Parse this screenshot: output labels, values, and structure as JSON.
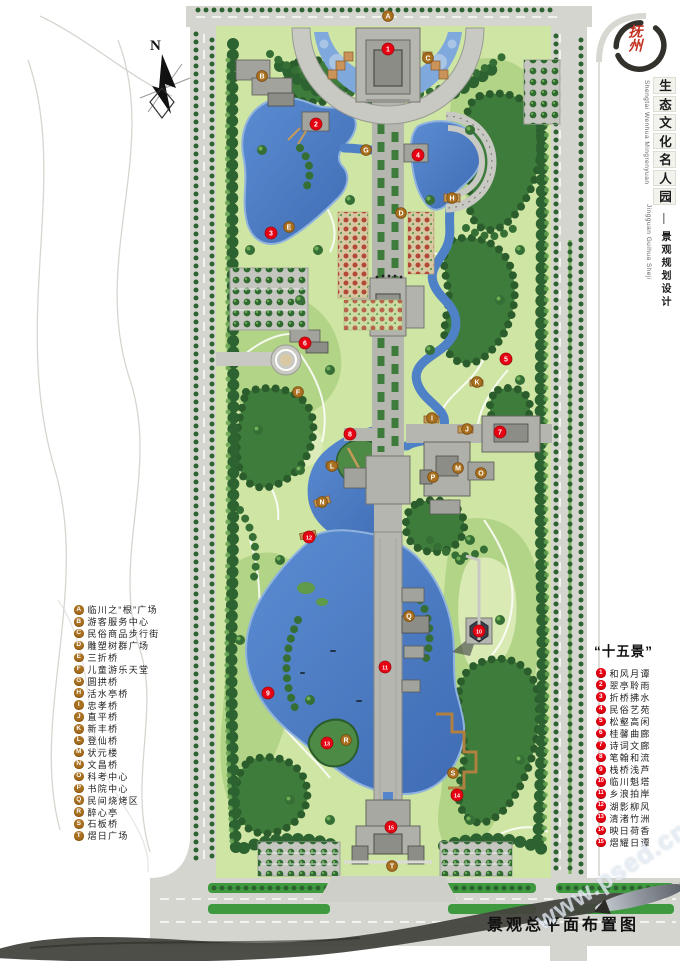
{
  "page": {
    "north_label": "N",
    "watermark": "www.psed.cn",
    "bottom_title": "景观总平面布置图"
  },
  "title_block": {
    "seal_text": "抚州",
    "main_title": "生态文化名人园",
    "main_title_pinyin": "Shengtai Wenhua Mingrenyuan",
    "separator": "—",
    "subtitle": "景观规划设计",
    "subtitle_pinyin": "Jingguan Guihua Sheji"
  },
  "legend_facilities": {
    "items": [
      {
        "key": "A",
        "label": "临川之“根”广场",
        "x": 388,
        "y": 16
      },
      {
        "key": "B",
        "label": "游客服务中心",
        "x": 262,
        "y": 76
      },
      {
        "key": "C",
        "label": "民俗商品步行街",
        "x": 428,
        "y": 58
      },
      {
        "key": "D",
        "label": "雕塑树群广场",
        "x": 401,
        "y": 213
      },
      {
        "key": "E",
        "label": "三折桥",
        "x": 289,
        "y": 227
      },
      {
        "key": "F",
        "label": "儿童游乐天堂",
        "x": 298,
        "y": 392
      },
      {
        "key": "G",
        "label": "圆拱桥",
        "x": 366,
        "y": 150
      },
      {
        "key": "H",
        "label": "活水亭桥",
        "x": 452,
        "y": 198
      },
      {
        "key": "I",
        "label": "忠孝桥",
        "x": 432,
        "y": 418
      },
      {
        "key": "J",
        "label": "直平桥",
        "x": 467,
        "y": 429
      },
      {
        "key": "K",
        "label": "新丰桥",
        "x": 477,
        "y": 382
      },
      {
        "key": "L",
        "label": "登仙桥",
        "x": 332,
        "y": 466
      },
      {
        "key": "M",
        "label": "状元楼",
        "x": 458,
        "y": 468
      },
      {
        "key": "N",
        "label": "文昌桥",
        "x": 322,
        "y": 502
      },
      {
        "key": "O",
        "label": "科考中心",
        "x": 481,
        "y": 473
      },
      {
        "key": "P",
        "label": "书院中心",
        "x": 433,
        "y": 477
      },
      {
        "key": "Q",
        "label": "民间烧烤区",
        "x": 409,
        "y": 616
      },
      {
        "key": "R",
        "label": "醉心亭",
        "x": 346,
        "y": 740
      },
      {
        "key": "S",
        "label": "石板桥",
        "x": 453,
        "y": 773
      },
      {
        "key": "T",
        "label": "熠日广场",
        "x": 392,
        "y": 866
      }
    ]
  },
  "legend_scenes": {
    "header": "“十五景”",
    "items": [
      {
        "num": "1",
        "label": "和风月谭",
        "x": 388,
        "y": 49
      },
      {
        "num": "2",
        "label": "翠亭聆雨",
        "x": 316,
        "y": 124
      },
      {
        "num": "3",
        "label": "折桥拂水",
        "x": 271,
        "y": 233
      },
      {
        "num": "4",
        "label": "民俗艺苑",
        "x": 418,
        "y": 155
      },
      {
        "num": "5",
        "label": "松壑高闲",
        "x": 506,
        "y": 359
      },
      {
        "num": "6",
        "label": "桂馨曲廊",
        "x": 305,
        "y": 343
      },
      {
        "num": "7",
        "label": "诗词文廊",
        "x": 500,
        "y": 432
      },
      {
        "num": "8",
        "label": "笔翰和流",
        "x": 350,
        "y": 434
      },
      {
        "num": "9",
        "label": "栈桥浅芦",
        "x": 268,
        "y": 693
      },
      {
        "num": "10",
        "label": "临川魁塔",
        "x": 479,
        "y": 631
      },
      {
        "num": "11",
        "label": "乡浪拍岸",
        "x": 385,
        "y": 667
      },
      {
        "num": "12",
        "label": "湖影柳风",
        "x": 309,
        "y": 537
      },
      {
        "num": "13",
        "label": "清渚竹洲",
        "x": 327,
        "y": 743
      },
      {
        "num": "14",
        "label": "映日荷香",
        "x": 457,
        "y": 795
      },
      {
        "num": "15",
        "label": "熠耀日谭",
        "x": 391,
        "y": 827
      }
    ]
  },
  "colors": {
    "water": "#4f81c6",
    "water_light": "#7fa8dc",
    "lawn": "#cfe5a4",
    "forest": "#3e7c3c",
    "road": "#d5d5cf",
    "plaza": "#b6b6b0",
    "badge_letter": "#a9701f",
    "badge_number": "#e60113",
    "seal_red": "#c4301f"
  }
}
